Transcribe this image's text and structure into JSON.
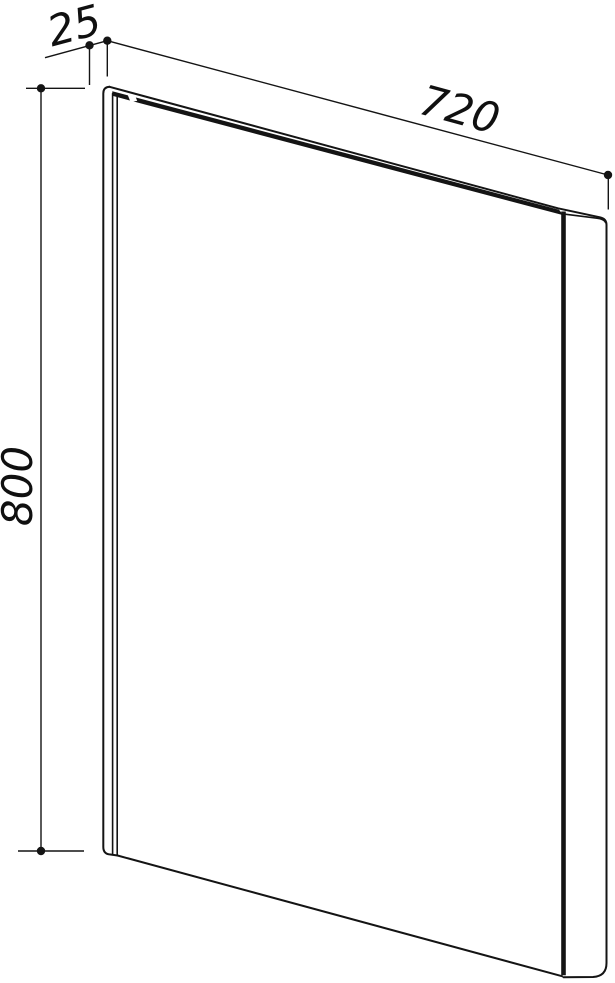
{
  "figure": {
    "kind": "technical dimension drawing of a flat rectangular panel (oblique view)",
    "colors": {
      "background": "#ffffff",
      "line": "#141414"
    },
    "dimensions": {
      "thickness": {
        "value": "25"
      },
      "width": {
        "value": "720"
      },
      "height": {
        "value": "800"
      }
    }
  }
}
